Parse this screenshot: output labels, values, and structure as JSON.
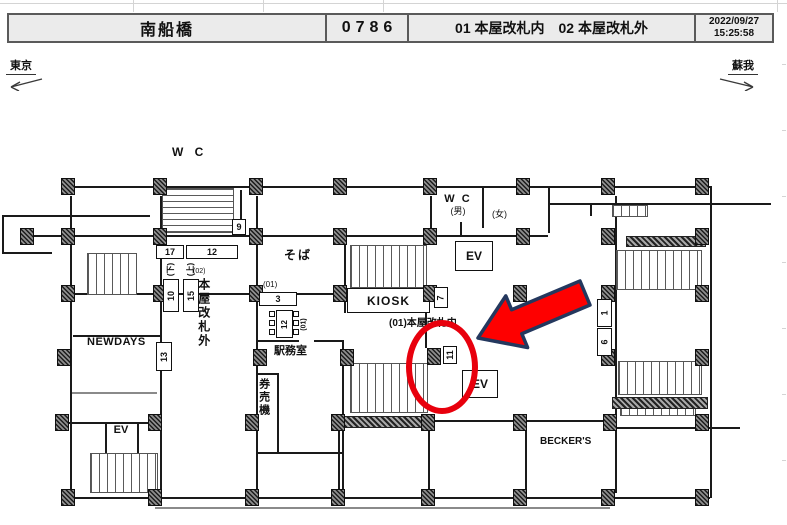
{
  "header": {
    "station": "南船橋",
    "code": "0786",
    "areas": "01 本屋改札内　02 本屋改札外",
    "date": "2022/09/27",
    "time": "15:25:58"
  },
  "directions": {
    "left_label": "東京",
    "right_label": "蘇我"
  },
  "rooms": {
    "wc_top": "W C",
    "wc_mens": "W C",
    "wc_mens_sub": "(男)",
    "wc_womens": "(女)",
    "ev": "EV",
    "soba": "そば",
    "kiosk": "KIOSK",
    "newdays": "NEWDAYS",
    "office": "駅務室",
    "ticket_machine": "券売機",
    "beckers": "BECKER'S"
  },
  "gates": {
    "inside_label": "(01)本屋改札内",
    "outside_prefix": "(02)",
    "outside_label": "本屋改札外",
    "group3_label": "(01)",
    "gate_unit_label": "(01)"
  },
  "cameras": {
    "c1": "1",
    "c3": "3",
    "c6": "6",
    "c7": "7",
    "c9": "9",
    "c10": "10",
    "c11": "11",
    "c12_top": "12",
    "c12_gate": "12",
    "c13": "13",
    "c15": "15",
    "c17": "17",
    "c10_dir": "(下)",
    "c15_dir": "(上)"
  },
  "highlight": {
    "selected_camera": "11"
  },
  "colors": {
    "header_bg": "#ebebeb",
    "line": "#1a1a1a",
    "highlight_red": "#e8000d",
    "arrow_fill": "#fe0000",
    "arrow_outline": "#24385e"
  }
}
